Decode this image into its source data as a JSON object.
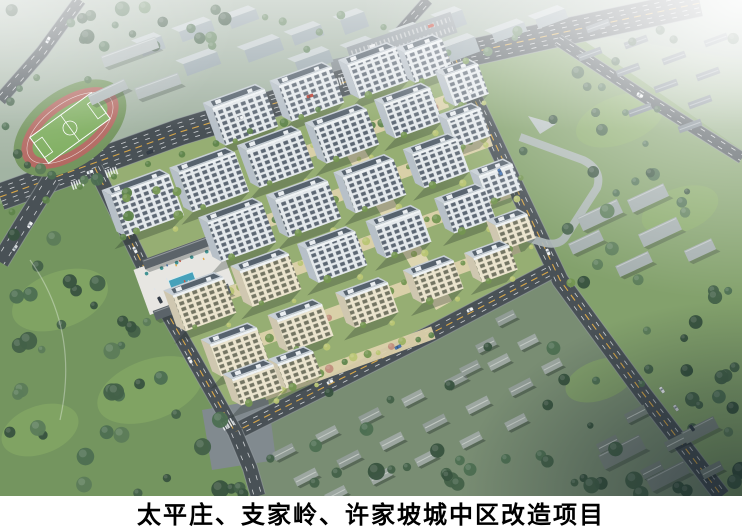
{
  "caption": {
    "text": "太平庄、支家岭、许家坡城中区改造项目",
    "background": "#ffffff",
    "color": "#000000"
  },
  "palette": {
    "base_top": "#b9c4bb",
    "base_mid": "#8fa97e",
    "base_low": "#79996a",
    "park": "#6f9158",
    "lawn": "#8ab05f",
    "tree1": "#2f4b36",
    "tree2": "#3c5a40",
    "tree3": "#46684a",
    "tree4": "#557752",
    "ctree1": "#6f9149",
    "ctree2": "#9ab05c",
    "ctree3": "#b8c46e",
    "ctree4": "#597f43",
    "blossom": "#c08a77",
    "road": "#42494f",
    "curb": "#9aa2a6",
    "lane_y": "#d9a441",
    "lane_w": "#f2f4f5",
    "paving": "#7d858b",
    "complex_green": "#93ab6d",
    "band": "#ddd1a9",
    "spine": "#e3d7b2",
    "face_w": "#e5e9ec",
    "win_w": "#57616e",
    "face_c": "#ece4cd",
    "win_c": "#6f6f5c",
    "side_w": "#b6bec7",
    "side_c": "#cfc6ad",
    "roof_rim": "#c7ced5",
    "roof_dark": "#505b67",
    "penthouse": "#eaeef1",
    "plaza": "#e8e6e2",
    "pool": "#3f9db8",
    "slab_dark": "#555c63",
    "ridge": "#9ba2a8",
    "accent_red": "#a84b38",
    "school": "#aab4b4",
    "school_side": "#7d8888",
    "parking": "#8a9298",
    "distant": "#96a4aa",
    "distant_top": "#c3ccce",
    "house": "#9aa49e",
    "house2": "#8e9892",
    "house_ridge": "#c9cfc9",
    "nhouse": "#6e7a82",
    "nridge": "#a5aeb4",
    "eslab": "#a2abab",
    "brslab": "#76817a",
    "track_red": "#b2635b",
    "infield": "#77a557",
    "pitch_line": "#ffffff",
    "fog": "#ffffff",
    "vignette": "#0d1a24"
  }
}
